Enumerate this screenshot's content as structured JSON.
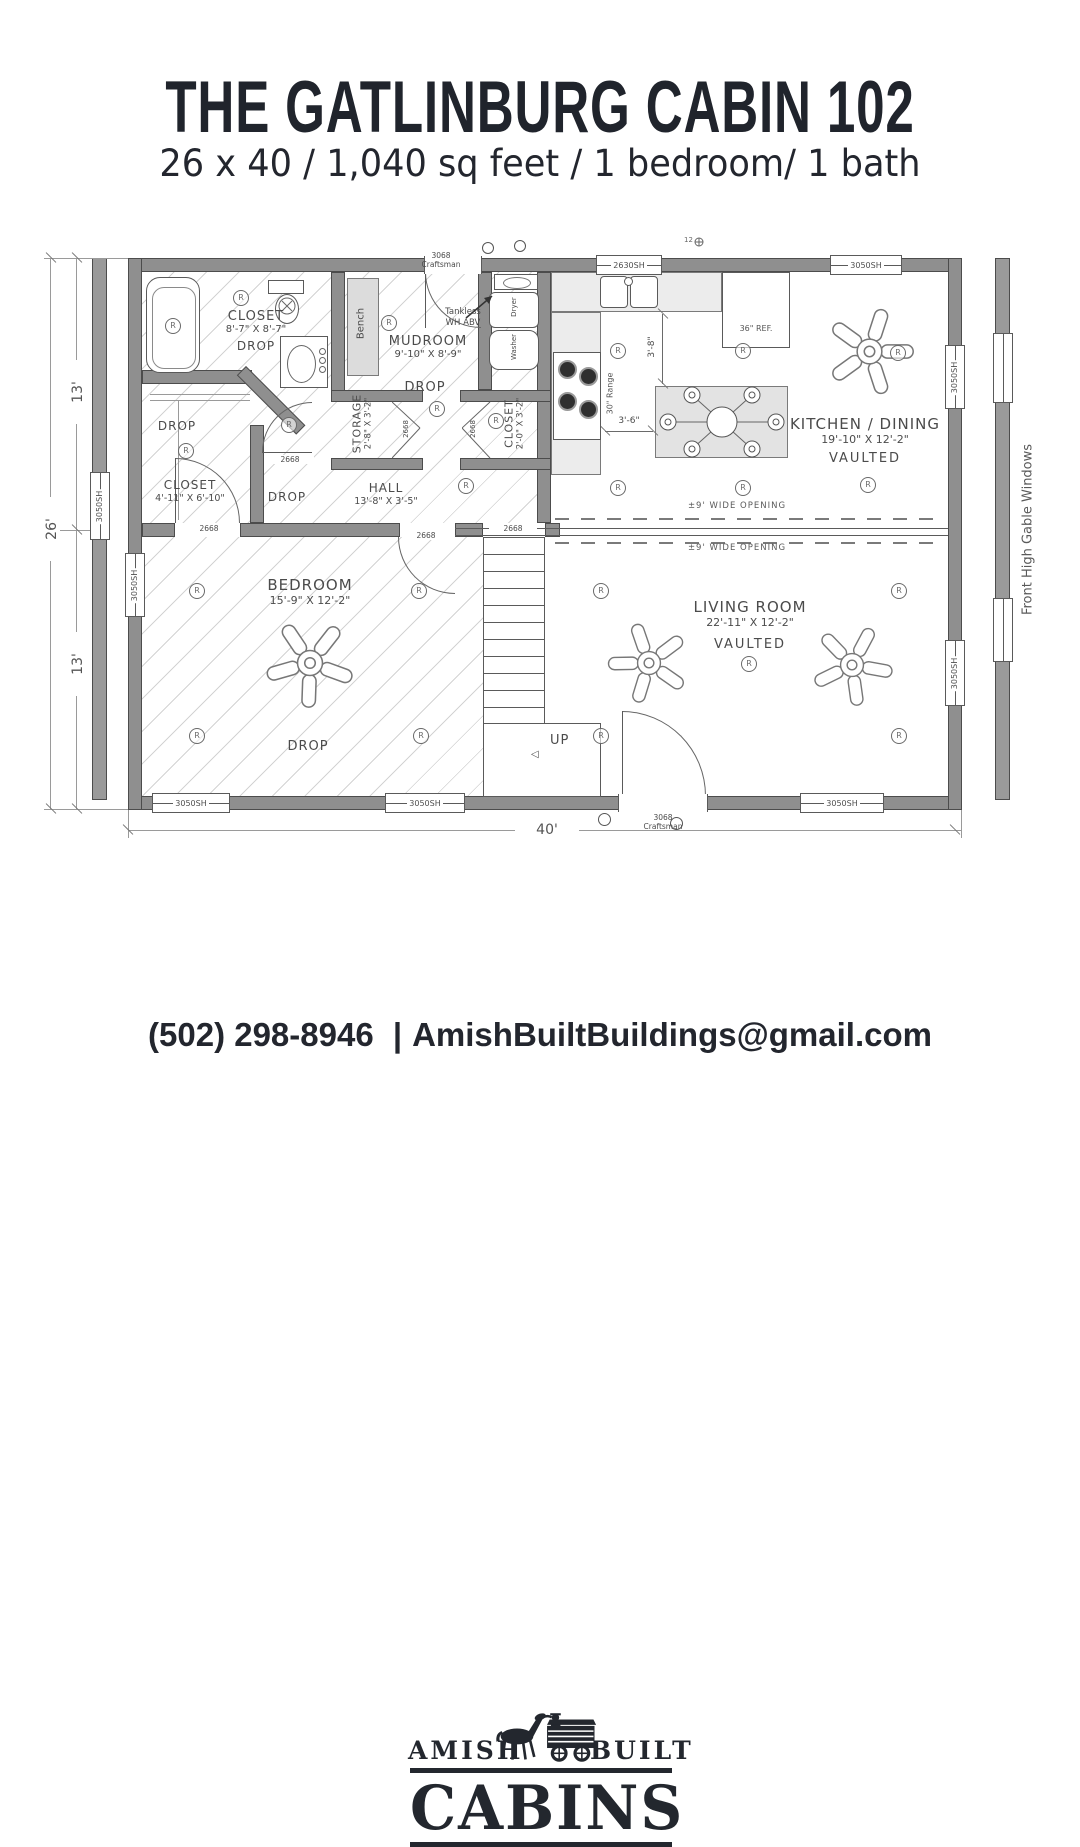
{
  "header": {
    "title": "THE GATLINBURG CABIN 102",
    "subtitle": "26 x 40 / 1,040 sq feet / 1 bedroom/ 1 bath"
  },
  "plan": {
    "ext_dims": {
      "left_top": "13'",
      "left_total": "26'",
      "left_bottom": "13'",
      "bottom": "40'"
    },
    "inner_dims": {
      "counter_to_island_v": "3'-8\"",
      "counter_to_island_h": "3'-6\""
    },
    "note_right": "Front High Gable Windows",
    "rooms": {
      "bath": {
        "name": "CLOSET",
        "dims": "8'-7\" X 8'-7\"",
        "note": "DROP"
      },
      "mudroom": {
        "name": "MUDROOM",
        "dims": "9'-10\" X 8'-9\""
      },
      "storage": {
        "name": "STORAGE",
        "dims": "2'-8\" X 3'-2\""
      },
      "wd_closet": {
        "name": "CLOSET",
        "dims": "2'-0\" X 3'-2\""
      },
      "closet": {
        "name": "CLOSET",
        "dims": "4'-11\" X 6'-10\""
      },
      "hall": {
        "name": "HALL",
        "dims": "13'-8\" X 3'-5\""
      },
      "kitchen": {
        "name": "KITCHEN / DINING",
        "dims": "19'-10\" X 12'-2\"",
        "note": "VAULTED"
      },
      "living": {
        "name": "LIVING ROOM",
        "dims": "22'-11\" X 12'-2\"",
        "note": "VAULTED"
      },
      "bedroom": {
        "name": "BEDROOM",
        "dims": "15'-9\" X 12'-2\""
      }
    },
    "labels": {
      "drop": "DROP",
      "up": "UP",
      "up_arrow": "◁",
      "bench": "Bench",
      "tankless_line1": "Tankless",
      "tankless_line2": "WH ABV",
      "fridge": "36\" REF.",
      "range": "30\" Range",
      "washer": "Washer",
      "dryer": "Dryer",
      "wide_opening": "±9' WIDE OPENING",
      "recessed": "R",
      "misc_12": "12"
    },
    "openings": {
      "door_big_line1": "3068",
      "door_big_line2": "Craftsman",
      "door_int": "2668",
      "win_large": "3050SH",
      "win_kitchen": "2630SH"
    }
  },
  "footer": {
    "logo": {
      "left": "AMISH",
      "right": "BUILT",
      "name": "CABINS"
    },
    "phone": "(502) 298-8946",
    "separator": "|",
    "email": "AmishBuiltBuildings@gmail.com"
  }
}
